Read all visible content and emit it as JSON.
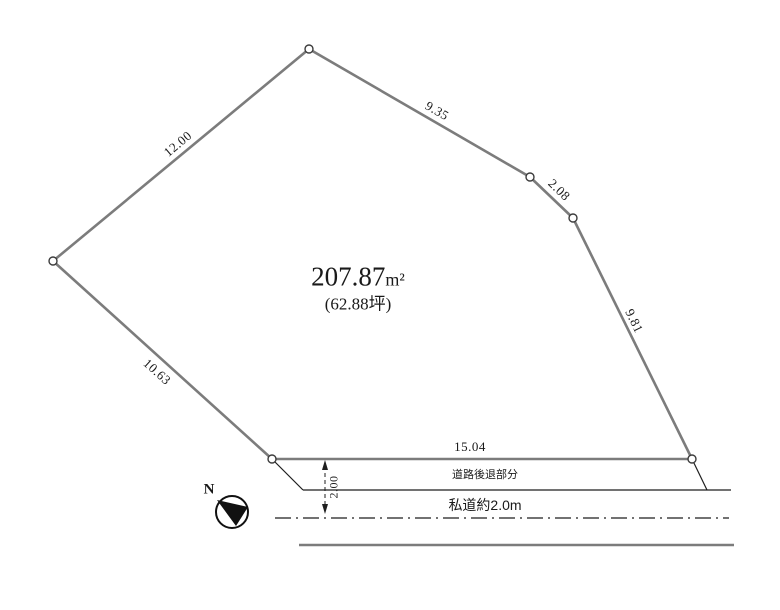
{
  "diagram": {
    "area": {
      "m2_value": "207.87",
      "m2_unit": "m²",
      "tsubo": "(62.88坪)"
    },
    "dimensions": {
      "edge_nw": "12.00",
      "edge_n": "9.35",
      "edge_ne": "2.08",
      "edge_e": "9.81",
      "edge_sw": "10.63",
      "edge_s": "15.04",
      "setback_depth": "2.00"
    },
    "labels": {
      "setback_area": "道路後退部分",
      "private_road": "私道約2.0m",
      "north": "N"
    },
    "colors": {
      "boundary_gray": "#7c7c7c",
      "line_black": "#1f1f1f"
    }
  }
}
